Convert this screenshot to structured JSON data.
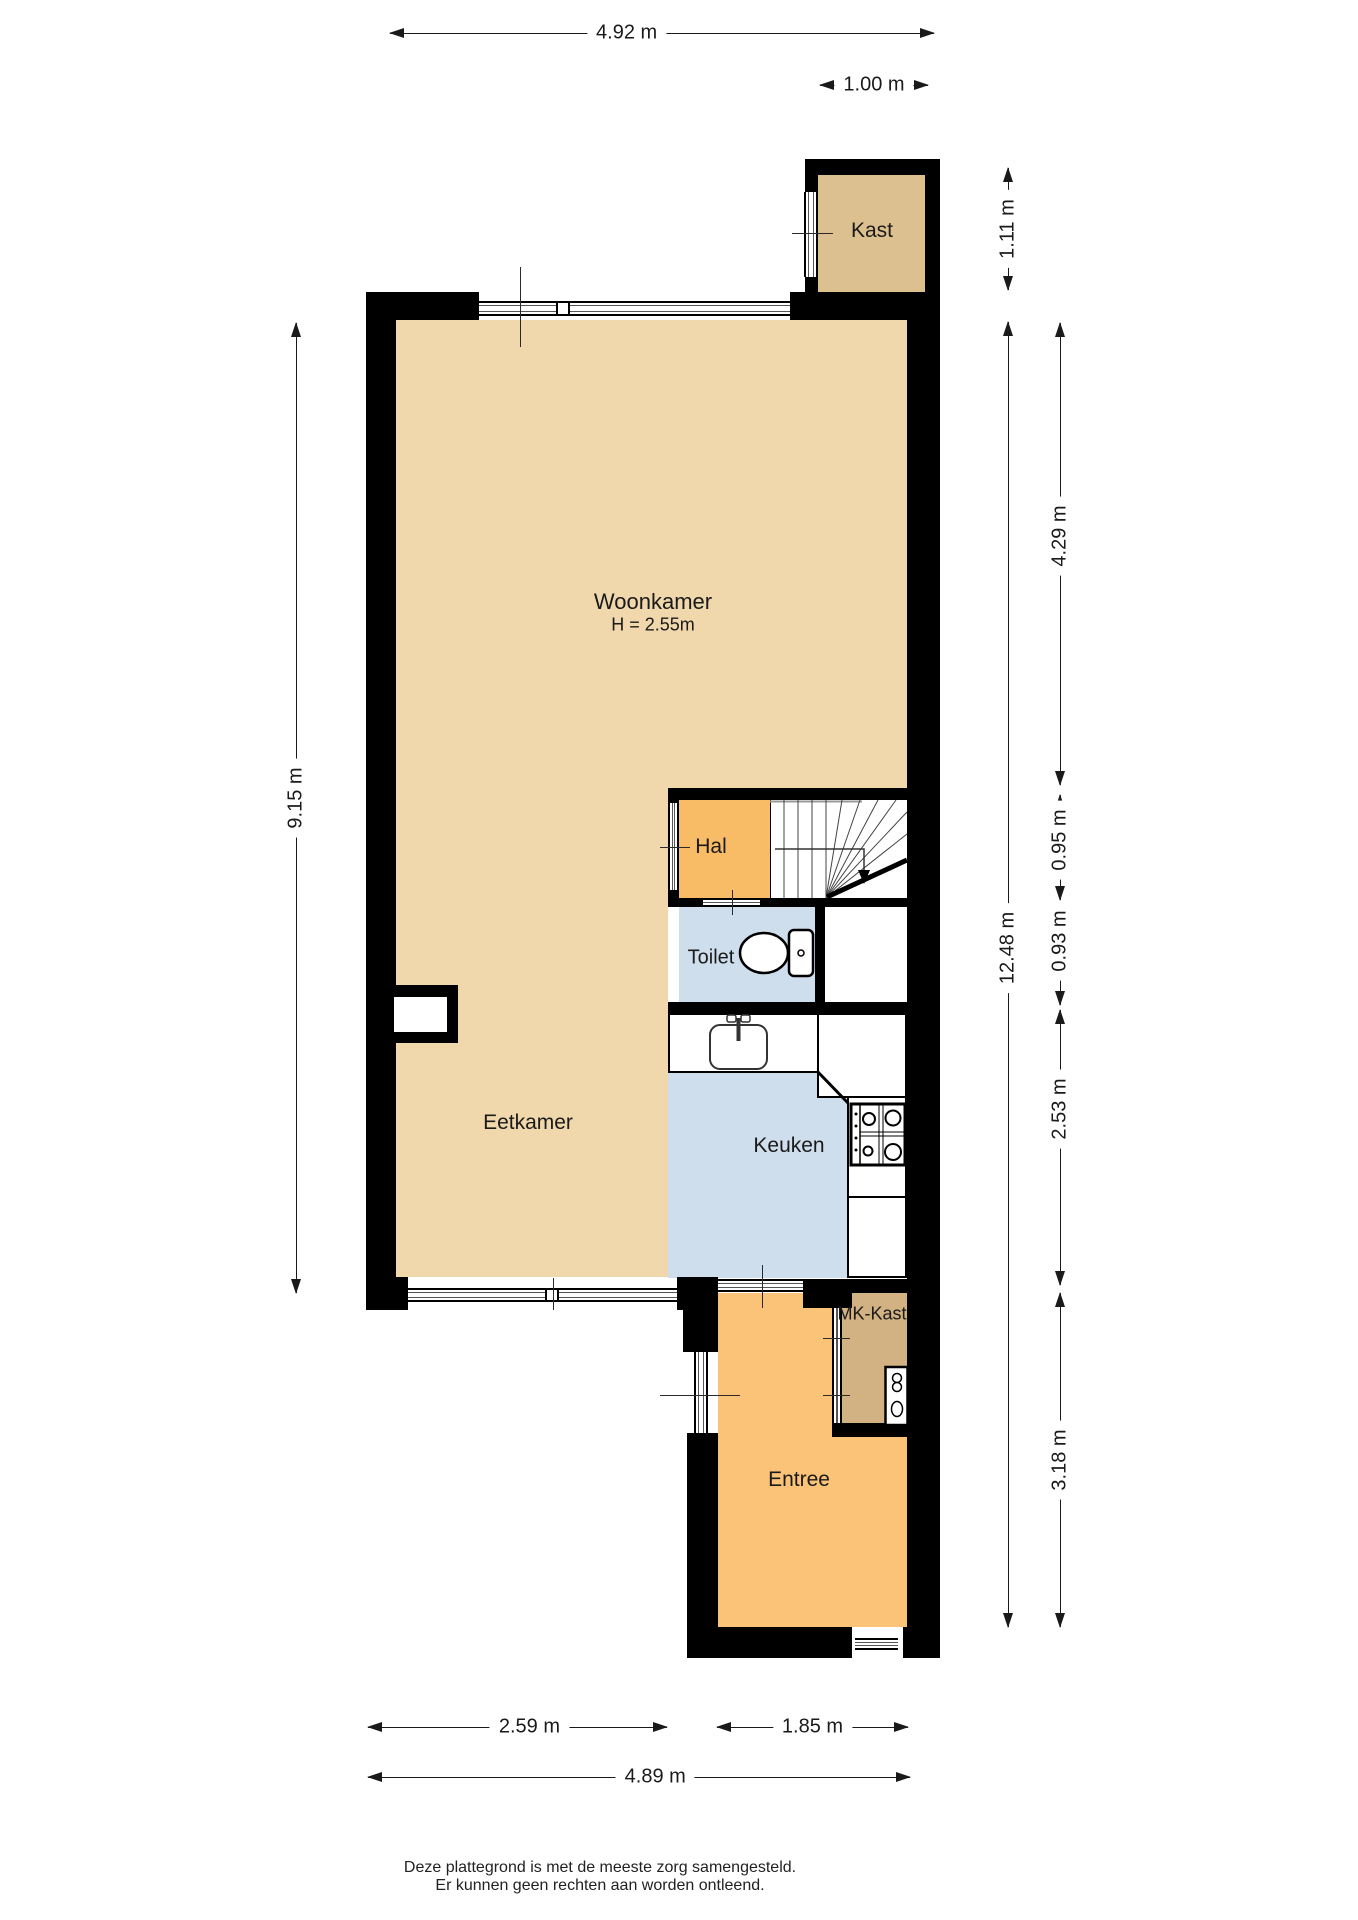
{
  "rooms": {
    "woonkamer": {
      "label": "Woonkamer",
      "ceiling_height": "H = 2.55m",
      "floor_color": "#f0d8ac"
    },
    "eetkamer": {
      "label": "Eetkamer",
      "floor_color": "#f0d8ac"
    },
    "keuken": {
      "label": "Keuken",
      "floor_color": "#cfdeed"
    },
    "hal": {
      "label": "Hal",
      "floor_color": "#f8bc66"
    },
    "toilet": {
      "label": "Toilet",
      "floor_color": "#cfdeed"
    },
    "kast": {
      "label": "Kast",
      "floor_color": "#dcc08f"
    },
    "mk_kast": {
      "label": "MK-Kast",
      "floor_color": "#d2b282"
    },
    "entree": {
      "label": "Entree",
      "floor_color": "#fac377"
    }
  },
  "dimensions": {
    "top_width": "4.92 m",
    "kast_width": "1.00 m",
    "kast_height": "1.11 m",
    "right_total": "12.48 m",
    "woonkamer_depth": "4.29 m",
    "hal_depth": "0.95 m",
    "toilet_depth": "0.93 m",
    "keuken_depth": "2.53 m",
    "entree_depth": "3.18 m",
    "left_height": "9.15 m",
    "eetkamer_width": "2.59 m",
    "entree_width": "1.85 m",
    "bottom_total": "4.89 m"
  },
  "colors": {
    "wall": "#000000",
    "dimension": "#1a1a1a",
    "living_floor": "#f0d8ac",
    "kast_floor": "#dcc08f",
    "mk_kast_floor": "#d2b282",
    "hal_floor": "#f8bc66",
    "entree_floor": "#fac377",
    "wet_room_floor": "#cfdeed"
  },
  "footer": {
    "line1": "Deze plattegrond is met de meeste zorg samengesteld.",
    "line2": "Er kunnen geen rechten aan worden ontleend."
  }
}
